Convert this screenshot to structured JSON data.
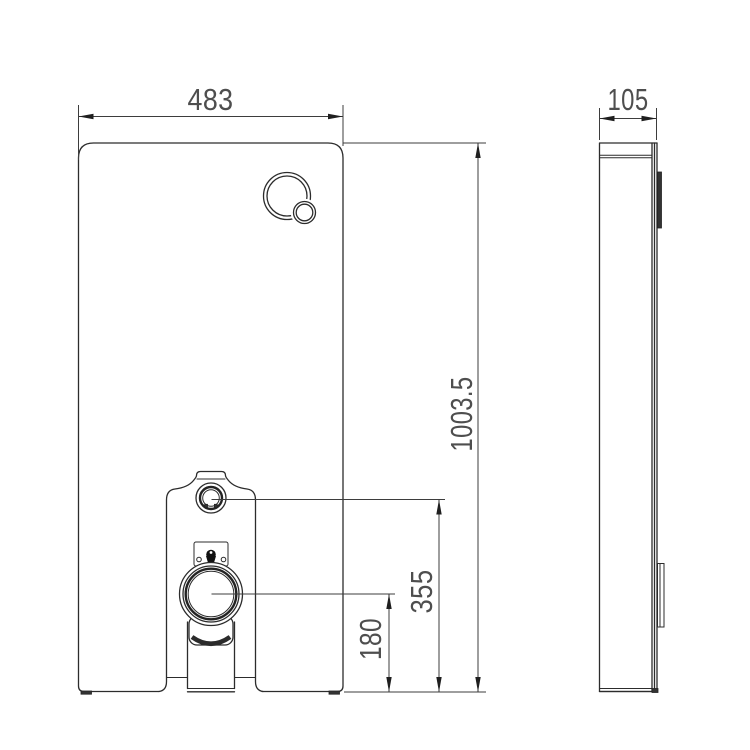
{
  "drawing": {
    "type": "technical-elevation-drawing",
    "subject": "sanitary-module-cistern-panel",
    "views": {
      "front": "front-elevation",
      "side": "side-elevation"
    },
    "dimensions": {
      "width": "483",
      "depth": "105",
      "height": "1003.5",
      "inlet_height": "355",
      "outlet_height": "180"
    }
  },
  "colors": {
    "background": "#ffffff",
    "object_line": "#2c2c2c",
    "dimension_line": "#3d3d3d",
    "dimension_text": "#4e4e4e",
    "dark_fill": "#333333"
  }
}
